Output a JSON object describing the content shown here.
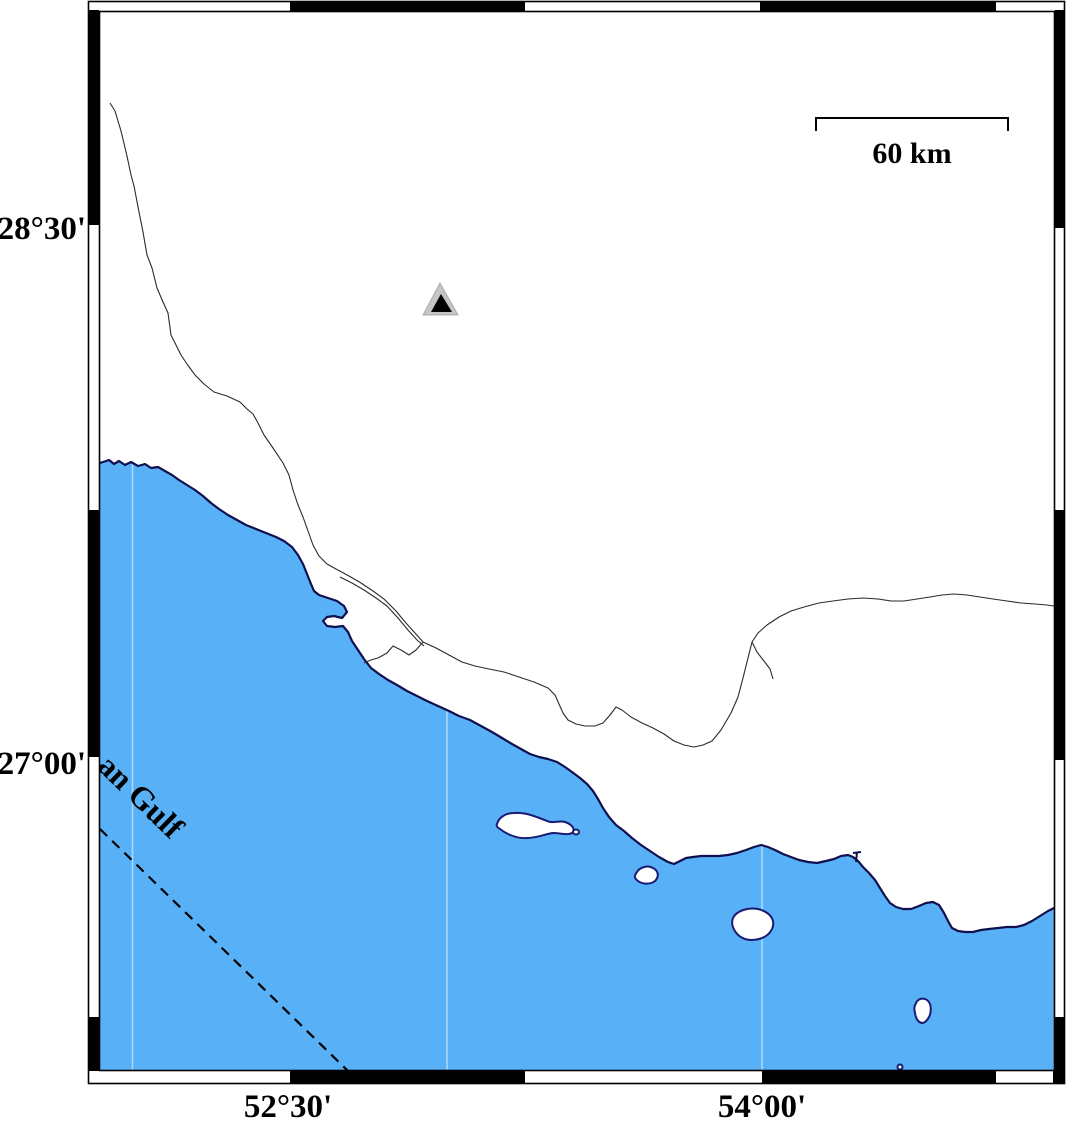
{
  "map": {
    "type": "coastal-map",
    "labels": {
      "lat_top": "28°30'",
      "lat_bottom": "27°00'",
      "lon_left": "52°30'",
      "lon_right": "54°00'"
    },
    "scalebar": {
      "label": "60 km"
    },
    "sea": {
      "label_visible": "an Gulf",
      "color": "#58B1F7",
      "gridline_longitudes": [
        "52°",
        "53°",
        "54°"
      ]
    },
    "colors": {
      "sea": "#58B1F7",
      "coastline": "#10104E",
      "island_stroke": "#1A1A72",
      "island_fill": "#FFFFFF",
      "border_line": "#2B2B2B",
      "frame_black": "#000000",
      "marker_gray": "#C5C5C5",
      "marker_black": "#000000",
      "dashed_boundary": "#000000",
      "gridline": "rgba(255,255,255,0.5)"
    },
    "marker": {
      "kind": "station-triangle",
      "symbol": "triangle-in-triangle"
    },
    "boundary": {
      "style": "dashed",
      "location": "sea-southwest"
    }
  }
}
